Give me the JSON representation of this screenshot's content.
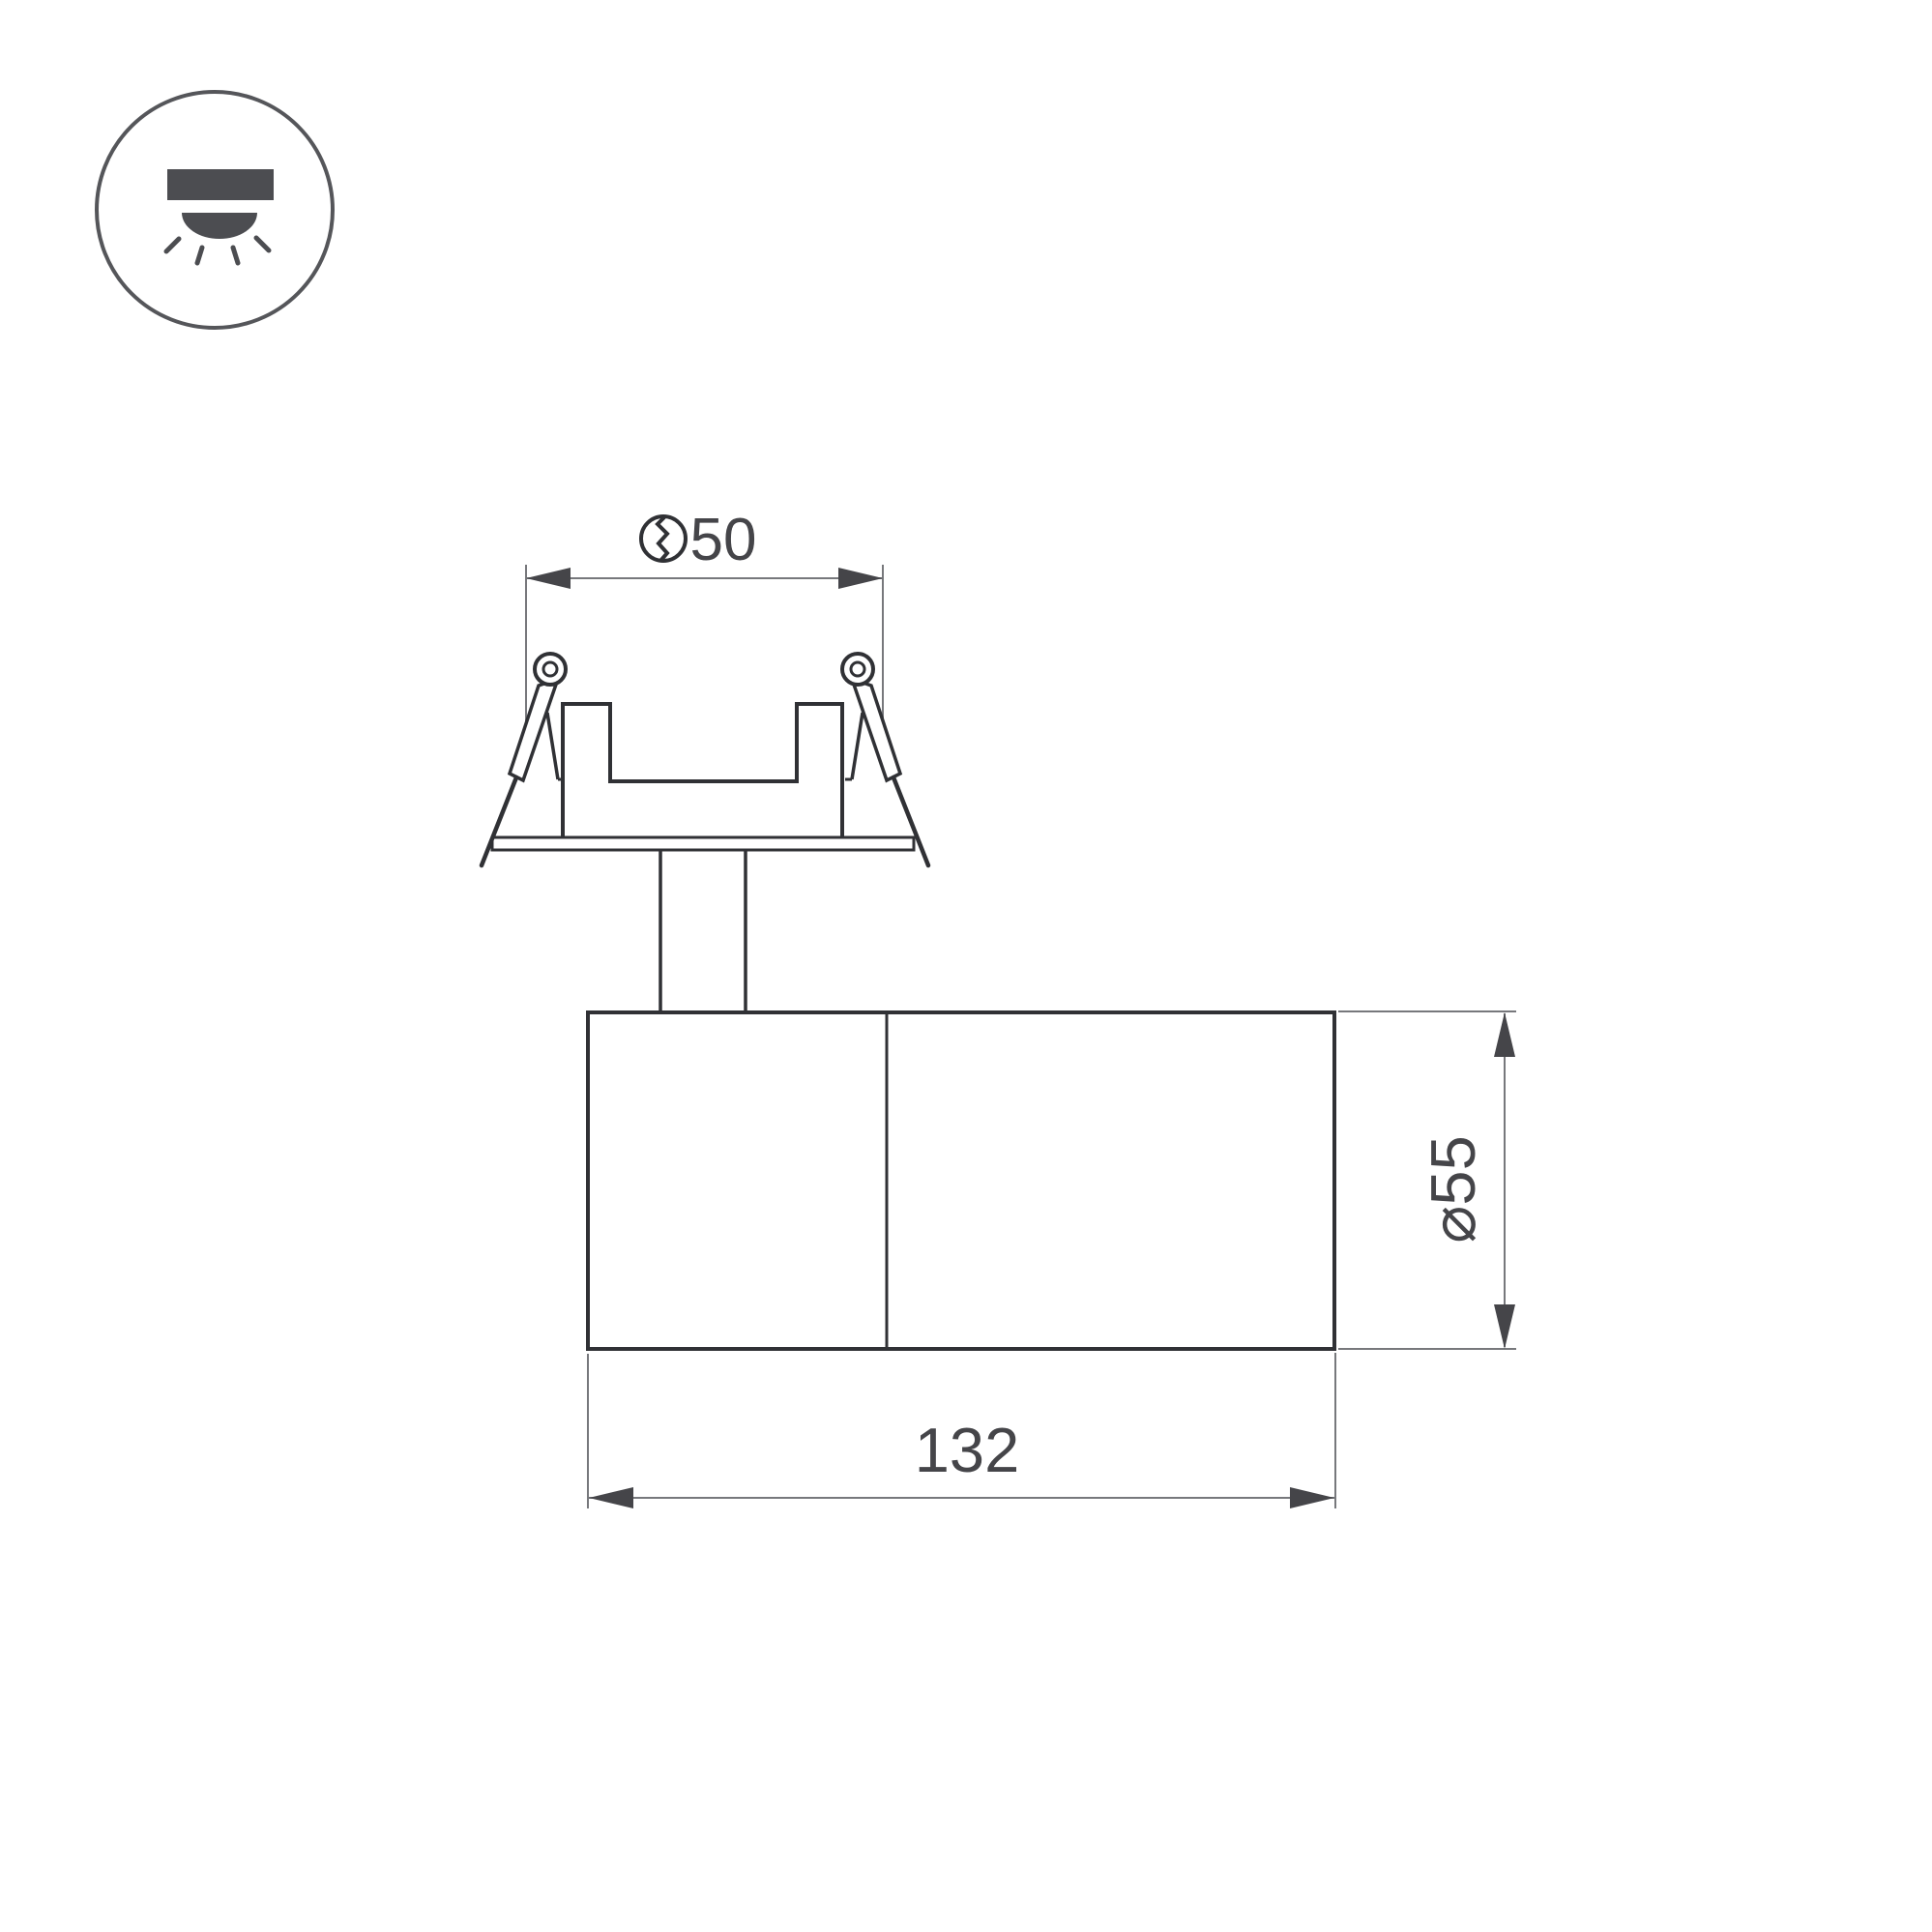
{
  "legend": {
    "icon": "recessed-downlight-icon"
  },
  "dimensions": {
    "cutout": {
      "icon": "hole-saw-cut-icon",
      "value": "50"
    },
    "body_diameter": {
      "label": "⌀55"
    },
    "body_length": {
      "label": "132"
    }
  },
  "colors": {
    "outline": "#303135",
    "dimension_line": "#77787c",
    "arrow_and_text": "#454549",
    "icon": "#4c4d51",
    "background": "#ffffff"
  }
}
